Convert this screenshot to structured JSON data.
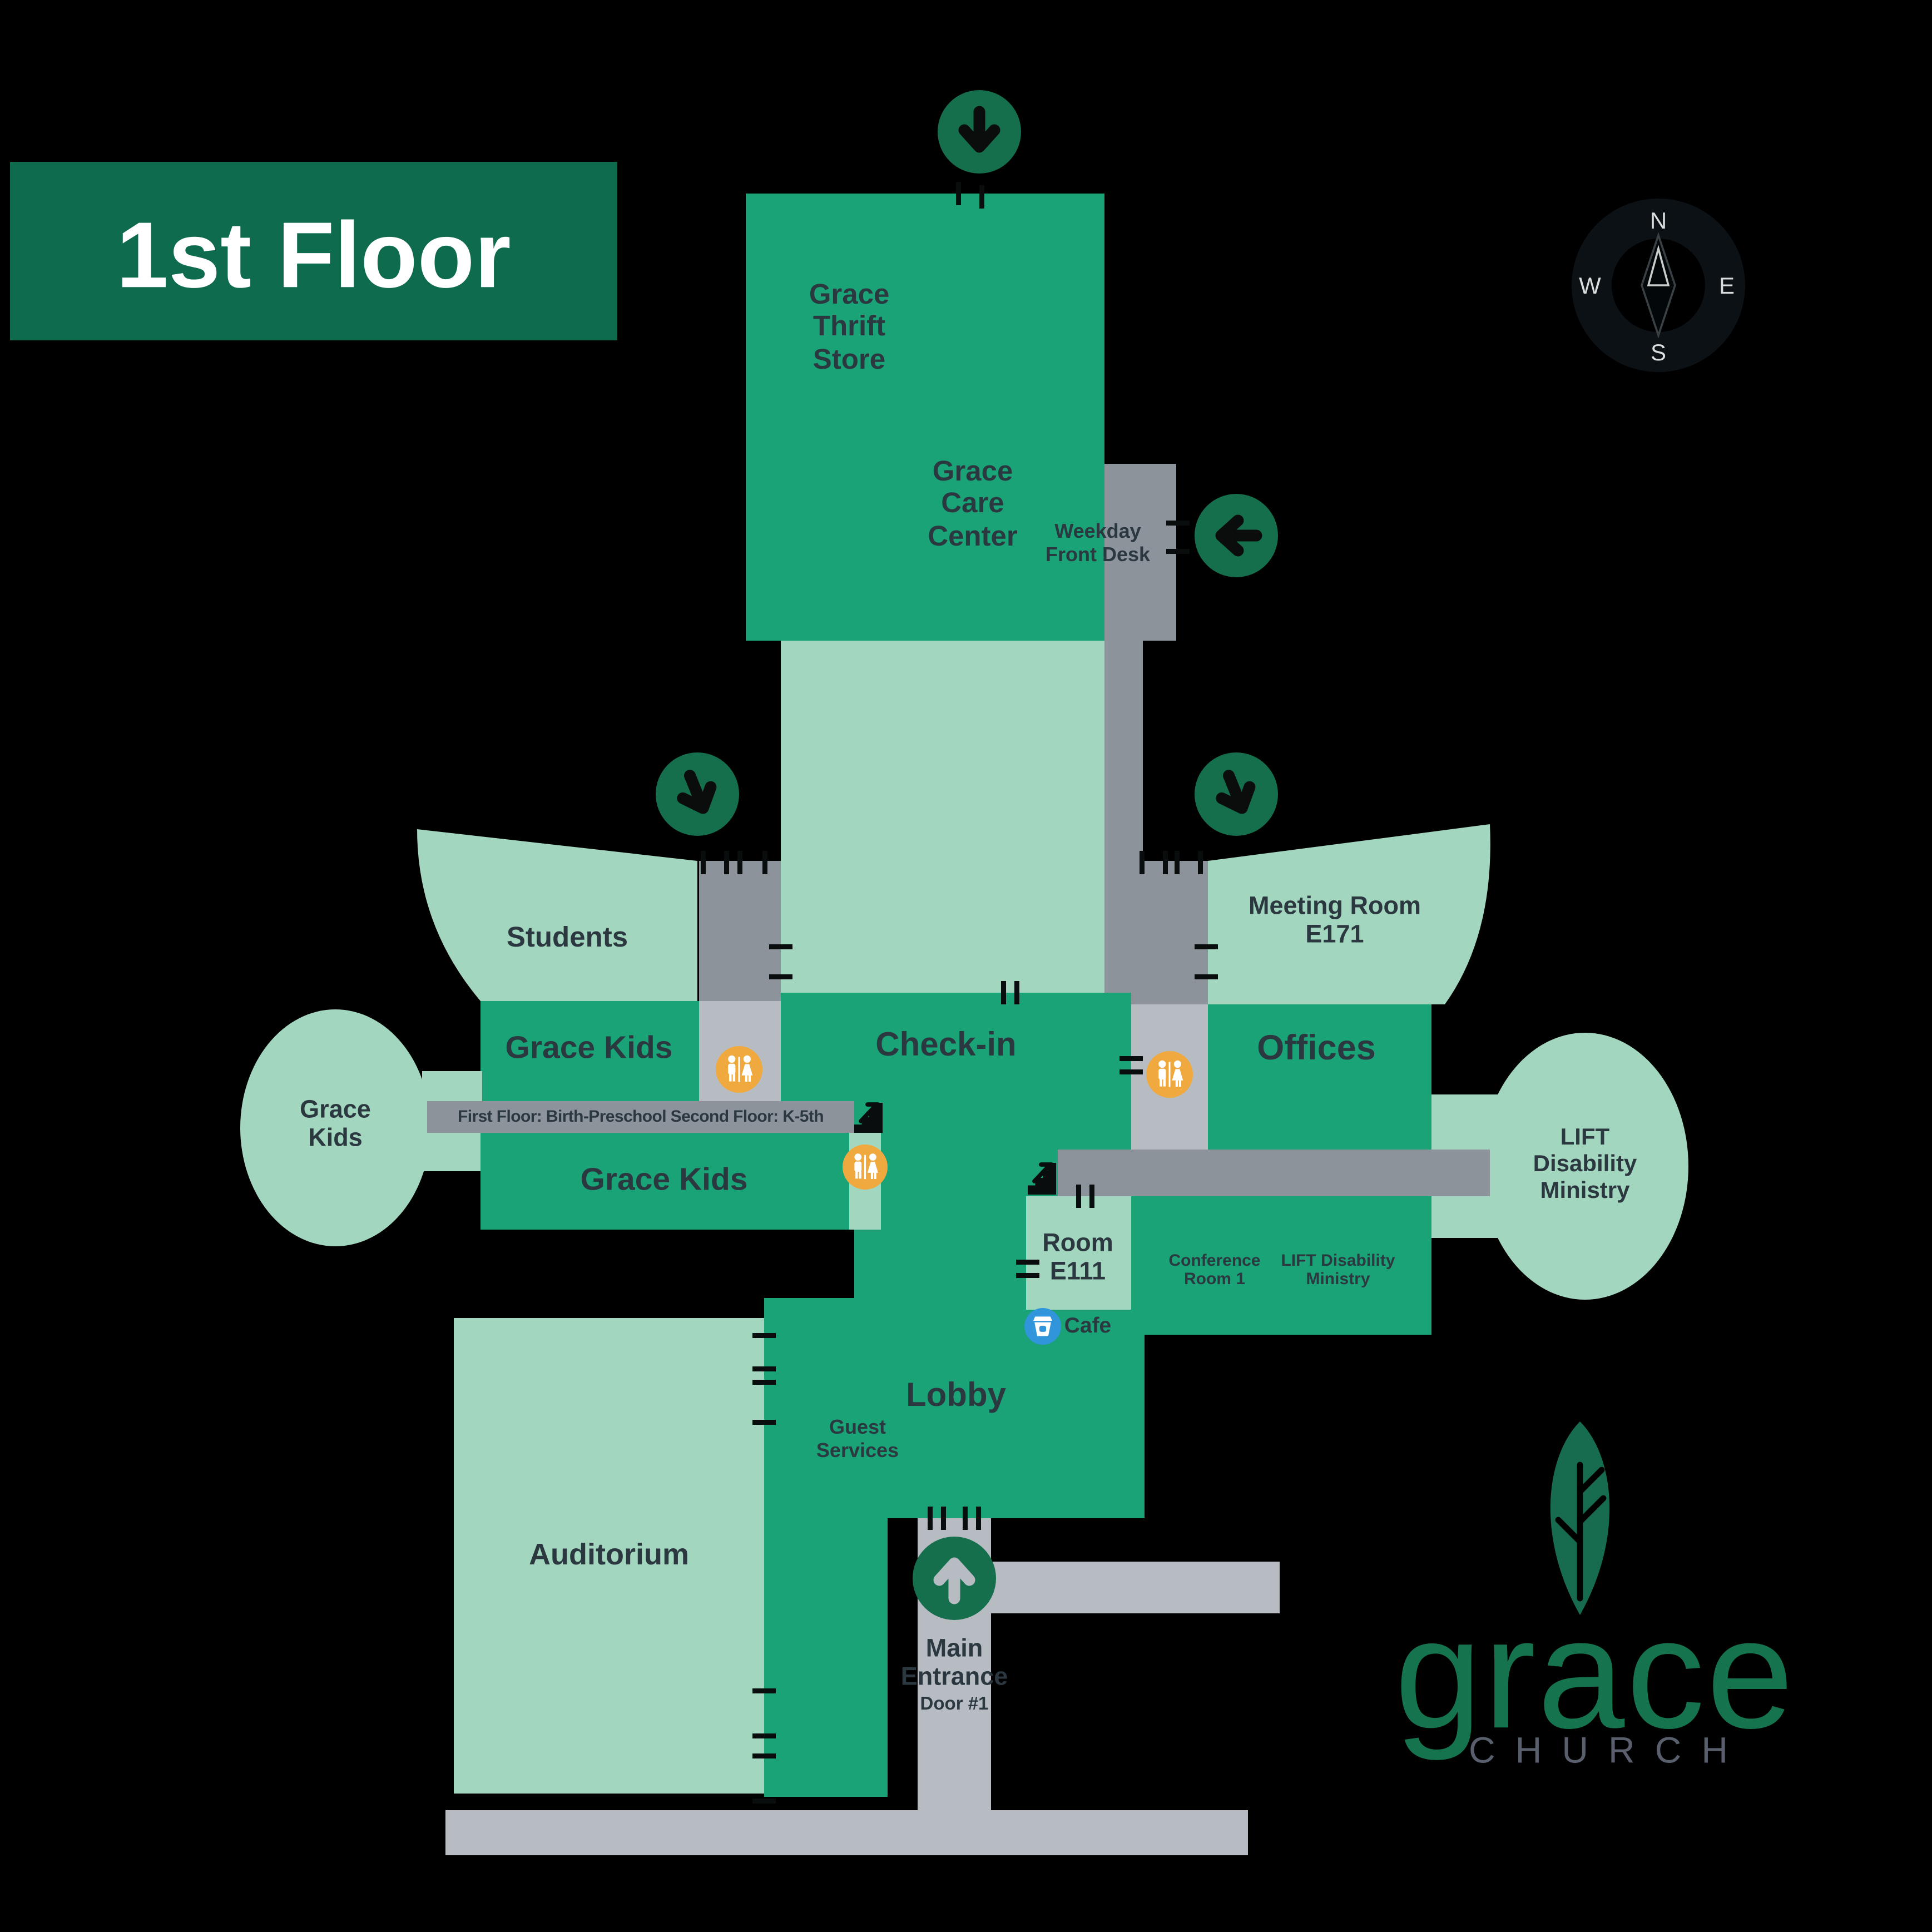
{
  "banner": {
    "label": "1st Floor"
  },
  "compass": {
    "north": "N",
    "east": "E",
    "south": "S",
    "west": "W"
  },
  "rooms": {
    "thrift": "Grace\nThrift\nStore",
    "care": "Grace\nCare\nCenter",
    "weekday": "Weekday\nFront Desk",
    "students": "Students",
    "meeting": "Meeting Room\nE171",
    "grace_kids_1": "Grace Kids",
    "grace_kids_2": "Grace Kids",
    "grace_kids_oval": "Grace\nKids",
    "checkin": "Check-in",
    "offices": "Offices",
    "hall_note": "First Floor: Birth-Preschool  Second Floor: K-5th",
    "room_e111": "Room\nE111",
    "conference": "Conference\nRoom 1",
    "lift": "LIFT Disability\nMinistry",
    "lift_oval": "LIFT\nDisability\nMinistry",
    "lobby": "Lobby",
    "cafe": "Cafe",
    "guest": "Guest\nServices",
    "main_entrance": "Main\nEntrance",
    "door": "Door #1",
    "auditorium": "Auditorium"
  },
  "logo": {
    "brand": "grace",
    "sub": "CHURCH"
  },
  "colors": {
    "map_green": "#19A377",
    "mint": "#A2D6BE",
    "dark_green": "#0F6B4E",
    "arrow_green": "#156F4D",
    "corridor_gray": "#8D939B",
    "walkway_gray": "#B7BCC3",
    "restroom_amber": "#F0A93E",
    "cafe_blue": "#3095DA",
    "text_dark": "#2B3840",
    "church_gray": "#5A5F6D",
    "logo_green": "#15734E"
  }
}
